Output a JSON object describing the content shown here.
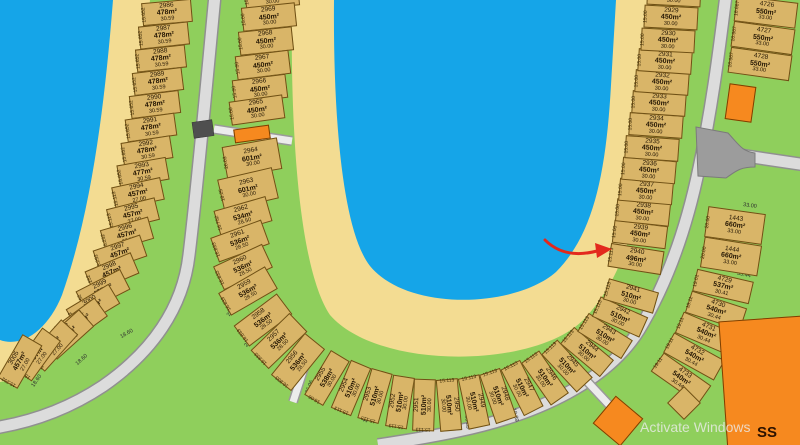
{
  "map": {
    "type": "subdivision-plat",
    "watermark": "Activate Windows",
    "buildings": {
      "ss_label": "SS"
    },
    "annotation": {
      "shape": "red-arrow",
      "points_at_lot": "2940"
    },
    "colors": {
      "water": "#15A5E8",
      "sand": "#F3DC92",
      "grass": "#8FCF5C",
      "road": "#DCDCDC",
      "lot": "#D9B568",
      "building": "#F6891F",
      "arrow": "#E3291D"
    },
    "columns": {
      "left": [
        {
          "n": "2986",
          "a": "478m²",
          "d": "30.59",
          "s": "15.652"
        },
        {
          "n": "2987",
          "a": "478m²",
          "d": "30.59",
          "s": "15.652"
        },
        {
          "n": "2988",
          "a": "478m²",
          "d": "30.59",
          "s": "15.652"
        },
        {
          "n": "2989",
          "a": "478m²",
          "d": "30.59",
          "s": "15.652"
        },
        {
          "n": "2990",
          "a": "478m²",
          "d": "30.59",
          "s": "15.652"
        },
        {
          "n": "2991",
          "a": "478m²",
          "d": "30.59",
          "s": "15.652"
        },
        {
          "n": "2992",
          "a": "478m²",
          "d": "30.59",
          "s": "15.652"
        },
        {
          "n": "2993",
          "a": "477m²",
          "d": "30.59",
          "s": "15.652"
        },
        {
          "n": "2994",
          "a": "457m²",
          "d": "27.00",
          "s": "15.113"
        },
        {
          "n": "2995",
          "a": "457m²",
          "d": "27.00",
          "s": "15.113"
        },
        {
          "n": "2996",
          "a": "457m²",
          "d": "27.00",
          "s": "15.252"
        },
        {
          "n": "2997",
          "a": "457m²",
          "d": "27.00",
          "s": "15.252"
        },
        {
          "n": "2998",
          "a": "457m²",
          "d": "27.00",
          "s": "15.252"
        },
        {
          "n": "2999",
          "a": "457m²",
          "d": "27.00",
          "s": "15.252"
        },
        {
          "n": "3000",
          "a": "457m²",
          "d": "27.00",
          "s": "15.252"
        },
        {
          "n": "3001",
          "a": "457m²",
          "d": "27.00",
          "s": "15.252"
        },
        {
          "n": "3002",
          "a": "457m²",
          "d": "27.00",
          "s": "15.252"
        },
        {
          "n": "3003",
          "a": "457m²",
          "d": "27.00",
          "s": "15.252"
        },
        {
          "n": "3004",
          "a": "457m²",
          "d": "27.00",
          "s": "15.252"
        },
        {
          "n": "3005",
          "a": "457m²",
          "d": "27.00",
          "s": "15.252"
        }
      ],
      "u": [
        {
          "n": "2970",
          "a": "450m²",
          "d": "30.00",
          "s": "15.00"
        },
        {
          "n": "2969",
          "a": "450m²",
          "d": "30.00",
          "s": "15.00"
        },
        {
          "n": "2968",
          "a": "450m²",
          "d": "30.00",
          "s": "15.00"
        },
        {
          "n": "2967",
          "a": "450m²",
          "d": "30.00",
          "s": "15.00"
        },
        {
          "n": "2966",
          "a": "450m²",
          "d": "30.00",
          "s": "15.00"
        },
        {
          "n": "2965",
          "a": "450m²",
          "d": "30.00",
          "s": "15.00"
        },
        {
          "n": "2964",
          "a": "601m²",
          "d": "30.00",
          "s": "20.03"
        },
        {
          "n": "2963",
          "a": "601m²",
          "d": "30.00",
          "s": "18.25"
        },
        {
          "n": "2962",
          "a": "534m²",
          "d": "28.50",
          "s": "16.752"
        },
        {
          "n": "2961",
          "a": "536m²",
          "d": "28.50",
          "s": "16.833"
        },
        {
          "n": "2960",
          "a": "536m²",
          "d": "28.50",
          "s": "16.833"
        },
        {
          "n": "2959",
          "a": "536m²",
          "d": "28.50",
          "s": "16.833"
        },
        {
          "n": "2958",
          "a": "536m²",
          "d": "28.50",
          "s": "16.833"
        },
        {
          "n": "2957",
          "a": "536m²",
          "d": "28.50",
          "s": "16.833"
        },
        {
          "n": "2956",
          "a": "536m²",
          "d": "28.50",
          "s": "16.833"
        },
        {
          "n": "2955",
          "a": "538m²",
          "d": "30.00",
          "s": "16.06"
        },
        {
          "n": "2954",
          "a": "510m²",
          "d": "30.00",
          "s": "15.113"
        },
        {
          "n": "2953",
          "a": "510m²",
          "d": "30.00",
          "s": "15.113"
        },
        {
          "n": "2952",
          "a": "510m²",
          "d": "30.00",
          "s": "15.113"
        },
        {
          "n": "2951",
          "a": "510m²",
          "d": "30.00",
          "s": "15.113"
        },
        {
          "n": "2950",
          "a": "510m²",
          "d": "30.00",
          "s": "15.113"
        },
        {
          "n": "2949",
          "a": "510m²",
          "d": "30.00",
          "s": "15.113"
        },
        {
          "n": "2948",
          "a": "510m²",
          "d": "30.00",
          "s": "15.113"
        },
        {
          "n": "2947",
          "a": "510m²",
          "d": "30.00",
          "s": "15.113"
        },
        {
          "n": "2946",
          "a": "510m²",
          "d": "30.00",
          "s": "15.113"
        },
        {
          "n": "2945",
          "a": "510m²",
          "d": "30.00",
          "s": "15.113"
        },
        {
          "n": "2944",
          "a": "510m²",
          "d": "30.00",
          "s": "15.113"
        },
        {
          "n": "2943",
          "a": "510m²",
          "d": "30.00",
          "s": "15.113"
        },
        {
          "n": "2942",
          "a": "510m²",
          "d": "30.00",
          "s": "15.113"
        },
        {
          "n": "2941",
          "a": "510m²",
          "d": "30.00",
          "s": "15.113"
        },
        {
          "n": "2940",
          "a": "496m²",
          "d": "30.00",
          "s": "15.113"
        },
        {
          "n": "2939",
          "a": "450m²",
          "d": "30.00",
          "s": "15.00"
        },
        {
          "n": "2938",
          "a": "450m²",
          "d": "30.00",
          "s": "15.00"
        },
        {
          "n": "2937",
          "a": "450m²",
          "d": "30.00",
          "s": "15.00"
        },
        {
          "n": "2936",
          "a": "450m²",
          "d": "30.00",
          "s": "15.00"
        },
        {
          "n": "2935",
          "a": "450m²",
          "d": "30.00",
          "s": "15.00"
        },
        {
          "n": "2934",
          "a": "450m²",
          "d": "30.00",
          "s": "15.00"
        },
        {
          "n": "2933",
          "a": "450m²",
          "d": "30.00",
          "s": "15.00"
        },
        {
          "n": "2932",
          "a": "450m²",
          "d": "30.00",
          "s": "15.00"
        },
        {
          "n": "2931",
          "a": "450m²",
          "d": "30.00",
          "s": "15.00"
        },
        {
          "n": "2930",
          "a": "450m²",
          "d": "30.00",
          "s": "15.00"
        },
        {
          "n": "2929",
          "a": "450m²",
          "d": "30.00",
          "s": "15.00"
        },
        {
          "n": "2928",
          "a": "450m²",
          "d": "30.00",
          "s": "15.00"
        }
      ],
      "right": [
        {
          "n": "4726",
          "a": "550m²",
          "d": "33.00",
          "s": "16.667"
        },
        {
          "n": "4727",
          "a": "550m²",
          "d": "33.00",
          "s": "16.667"
        },
        {
          "n": "4728",
          "a": "550m²",
          "d": "33.00",
          "s": "16.667"
        },
        {
          "n": "1443",
          "a": "660m²",
          "d": "33.00",
          "s": "20.00"
        },
        {
          "n": "1444",
          "a": "660m²",
          "d": "33.00",
          "s": "20.00"
        },
        {
          "n": "4729",
          "a": "537m²",
          "d": "30.41",
          "s": "19.01"
        },
        {
          "n": "4730",
          "a": "540m²",
          "d": "30.44",
          "s": "18.11"
        },
        {
          "n": "4731",
          "a": "540m²",
          "d": "30.44",
          "s": "19.11"
        },
        {
          "n": "4732",
          "a": "540m²",
          "d": "30.44",
          "s": "19.11"
        },
        {
          "n": "4733",
          "a": "540m²",
          "d": "30.44",
          "s": "19.11"
        }
      ]
    },
    "edge_dims": [
      "18.60",
      "18.60",
      "18.60",
      "20.78",
      "20.78",
      "36.06",
      "18.89",
      "18.89",
      "18.89",
      "18.89",
      "33.00",
      "35.44"
    ]
  }
}
